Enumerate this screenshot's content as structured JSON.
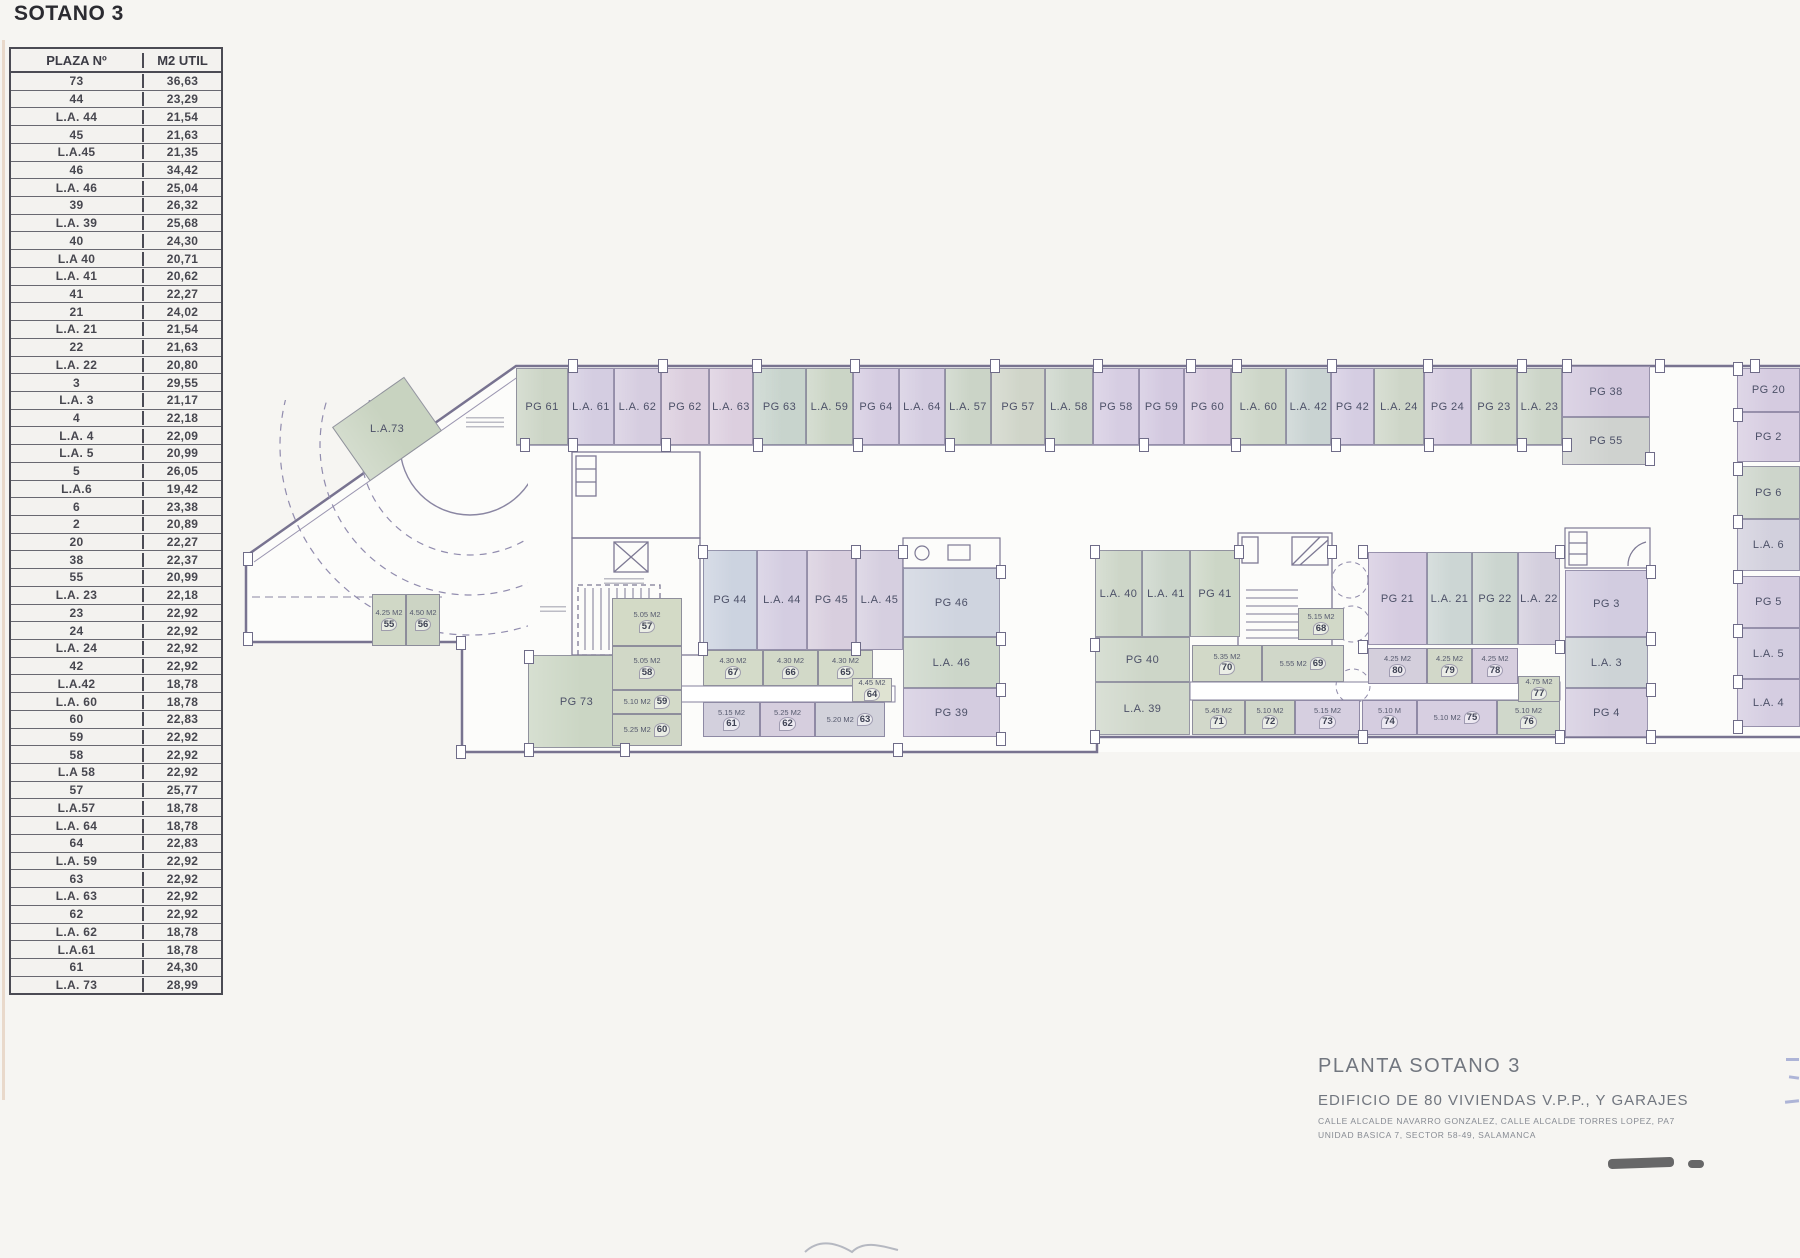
{
  "page_title": "SOTANO 3",
  "table": {
    "headers": [
      "PLAZA Nº",
      "M2 UTIL"
    ],
    "rows": [
      [
        "73",
        "36,63"
      ],
      [
        "44",
        "23,29"
      ],
      [
        "L.A. 44",
        "21,54"
      ],
      [
        "45",
        "21,63"
      ],
      [
        "L.A.45",
        "21,35"
      ],
      [
        "46",
        "34,42"
      ],
      [
        "L.A. 46",
        "25,04"
      ],
      [
        "39",
        "26,32"
      ],
      [
        "L.A. 39",
        "25,68"
      ],
      [
        "40",
        "24,30"
      ],
      [
        "L.A 40",
        "20,71"
      ],
      [
        "L.A. 41",
        "20,62"
      ],
      [
        "41",
        "22,27"
      ],
      [
        "21",
        "24,02"
      ],
      [
        "L.A. 21",
        "21,54"
      ],
      [
        "22",
        "21,63"
      ],
      [
        "L.A. 22",
        "20,80"
      ],
      [
        "3",
        "29,55"
      ],
      [
        "L.A. 3",
        "21,17"
      ],
      [
        "4",
        "22,18"
      ],
      [
        "L.A. 4",
        "22,09"
      ],
      [
        "L.A. 5",
        "20,99"
      ],
      [
        "5",
        "26,05"
      ],
      [
        "L.A.6",
        "19,42"
      ],
      [
        "6",
        "23,38"
      ],
      [
        "2",
        "20,89"
      ],
      [
        "20",
        "22,27"
      ],
      [
        "38",
        "22,37"
      ],
      [
        "55",
        "20,99"
      ],
      [
        "L.A. 23",
        "22,18"
      ],
      [
        "23",
        "22,92"
      ],
      [
        "24",
        "22,92"
      ],
      [
        "L.A. 24",
        "22,92"
      ],
      [
        "42",
        "22,92"
      ],
      [
        "L.A.42",
        "18,78"
      ],
      [
        "L.A. 60",
        "18,78"
      ],
      [
        "60",
        "22,83"
      ],
      [
        "59",
        "22,92"
      ],
      [
        "58",
        "22,92"
      ],
      [
        "L.A 58",
        "22,92"
      ],
      [
        "57",
        "25,77"
      ],
      [
        "L.A.57",
        "18,78"
      ],
      [
        "L.A. 64",
        "18,78"
      ],
      [
        "64",
        "22,83"
      ],
      [
        "L.A. 59",
        "22,92"
      ],
      [
        "63",
        "22,92"
      ],
      [
        "L.A. 63",
        "22,92"
      ],
      [
        "62",
        "22,92"
      ],
      [
        "L.A. 62",
        "18,78"
      ],
      [
        "L.A.61",
        "18,78"
      ],
      [
        "61",
        "24,30"
      ],
      [
        "L.A. 73",
        "28,99"
      ]
    ]
  },
  "plan": {
    "stalls": [
      {
        "label": "PG 61",
        "x": 516,
        "y": 368,
        "w": 52,
        "h": 77,
        "fill": "#ccd5c6"
      },
      {
        "label": "L.A. 61",
        "x": 568,
        "y": 368,
        "w": 46,
        "h": 77,
        "fill": "#d4cde1"
      },
      {
        "label": "L.A. 62",
        "x": 614,
        "y": 368,
        "w": 47,
        "h": 77,
        "fill": "#d6cde0"
      },
      {
        "label": "PG 62",
        "x": 661,
        "y": 368,
        "w": 48,
        "h": 77,
        "fill": "#dbcede"
      },
      {
        "label": "L.A. 63",
        "x": 709,
        "y": 368,
        "w": 44,
        "h": 77,
        "fill": "#dccfdf"
      },
      {
        "label": "PG 63",
        "x": 753,
        "y": 368,
        "w": 53,
        "h": 77,
        "fill": "#c8d4cd"
      },
      {
        "label": "L.A. 59",
        "x": 806,
        "y": 368,
        "w": 47,
        "h": 77,
        "fill": "#cbd5c6"
      },
      {
        "label": "PG 64",
        "x": 853,
        "y": 368,
        "w": 46,
        "h": 77,
        "fill": "#d5cce1"
      },
      {
        "label": "L.A. 64",
        "x": 899,
        "y": 368,
        "w": 46,
        "h": 77,
        "fill": "#d5cde1"
      },
      {
        "label": "L.A. 57",
        "x": 945,
        "y": 368,
        "w": 46,
        "h": 77,
        "fill": "#cbd4c7"
      },
      {
        "label": "PG 57",
        "x": 991,
        "y": 368,
        "w": 54,
        "h": 77,
        "fill": "#d0d5c9"
      },
      {
        "label": "L.A. 58",
        "x": 1045,
        "y": 368,
        "w": 48,
        "h": 77,
        "fill": "#ccd5ca"
      },
      {
        "label": "PG 58",
        "x": 1093,
        "y": 368,
        "w": 46,
        "h": 77,
        "fill": "#d6cde2"
      },
      {
        "label": "PG 59",
        "x": 1139,
        "y": 368,
        "w": 45,
        "h": 77,
        "fill": "#d3c9e0"
      },
      {
        "label": "PG 60",
        "x": 1184,
        "y": 368,
        "w": 47,
        "h": 77,
        "fill": "#d8cce0"
      },
      {
        "label": "L.A. 60",
        "x": 1231,
        "y": 368,
        "w": 55,
        "h": 77,
        "fill": "#cdd6c8"
      },
      {
        "label": "L.A. 42",
        "x": 1286,
        "y": 368,
        "w": 45,
        "h": 77,
        "fill": "#c9d3d2"
      },
      {
        "label": "PG 42",
        "x": 1331,
        "y": 368,
        "w": 43,
        "h": 77,
        "fill": "#d5cde2"
      },
      {
        "label": "L.A. 24",
        "x": 1374,
        "y": 368,
        "w": 50,
        "h": 77,
        "fill": "#ced6c8"
      },
      {
        "label": "PG 24",
        "x": 1424,
        "y": 368,
        "w": 47,
        "h": 77,
        "fill": "#d6cde1"
      },
      {
        "label": "PG 23",
        "x": 1471,
        "y": 368,
        "w": 46,
        "h": 77,
        "fill": "#cfd7c9"
      },
      {
        "label": "L.A. 23",
        "x": 1517,
        "y": 368,
        "w": 45,
        "h": 77,
        "fill": "#ccd5c8"
      },
      {
        "label": "PG 38",
        "x": 1562,
        "y": 366,
        "w": 88,
        "h": 51,
        "fill": "#d3c9de"
      },
      {
        "label": "PG 55",
        "x": 1562,
        "y": 417,
        "w": 88,
        "h": 48,
        "fill": "#cfd2cf"
      },
      {
        "label": "PG 20",
        "x": 1737,
        "y": 368,
        "w": 63,
        "h": 44,
        "fill": "#d5cbe0"
      },
      {
        "label": "PG 2",
        "x": 1737,
        "y": 412,
        "w": 63,
        "h": 50,
        "fill": "#d7cde1"
      },
      {
        "label": "PG 6",
        "x": 1737,
        "y": 466,
        "w": 63,
        "h": 53,
        "fill": "#cdd5cb"
      },
      {
        "label": "L.A. 6",
        "x": 1737,
        "y": 519,
        "w": 63,
        "h": 52,
        "fill": "#d2d0dd"
      },
      {
        "label": "PG 5",
        "x": 1737,
        "y": 576,
        "w": 63,
        "h": 52,
        "fill": "#d4cce0"
      },
      {
        "label": "L.A. 5",
        "x": 1737,
        "y": 628,
        "w": 63,
        "h": 51,
        "fill": "#d3cde0"
      },
      {
        "label": "L.A. 4",
        "x": 1737,
        "y": 679,
        "w": 63,
        "h": 48,
        "fill": "#d5cde1"
      },
      {
        "label": "PG 44",
        "x": 703,
        "y": 550,
        "w": 54,
        "h": 100,
        "fill": "#ccd3e0"
      },
      {
        "label": "L.A. 44",
        "x": 757,
        "y": 550,
        "w": 50,
        "h": 100,
        "fill": "#d4cde1"
      },
      {
        "label": "PG 45",
        "x": 807,
        "y": 550,
        "w": 49,
        "h": 100,
        "fill": "#d8cede"
      },
      {
        "label": "L.A. 45",
        "x": 856,
        "y": 550,
        "w": 47,
        "h": 100,
        "fill": "#d6cfe0"
      },
      {
        "label": "PG 46",
        "x": 903,
        "y": 568,
        "w": 97,
        "h": 69,
        "fill": "#cfd4df"
      },
      {
        "label": "L.A. 46",
        "x": 903,
        "y": 637,
        "w": 97,
        "h": 51,
        "fill": "#ccd6c9"
      },
      {
        "label": "PG 39",
        "x": 903,
        "y": 688,
        "w": 97,
        "h": 49,
        "fill": "#d4cce0"
      },
      {
        "label": "PG 73",
        "x": 528,
        "y": 655,
        "w": 97,
        "h": 93,
        "fill": "#cbd6c4"
      },
      {
        "label": "L.A.73",
        "x": 343,
        "y": 396,
        "w": 88,
        "h": 66,
        "fill": "#c8d3c0",
        "rot": -35
      },
      {
        "label": "L.A. 40",
        "x": 1095,
        "y": 550,
        "w": 47,
        "h": 87,
        "fill": "#cdd6c8"
      },
      {
        "label": "L.A. 41",
        "x": 1142,
        "y": 550,
        "w": 48,
        "h": 87,
        "fill": "#cbd5ca"
      },
      {
        "label": "PG 41",
        "x": 1190,
        "y": 550,
        "w": 50,
        "h": 87,
        "fill": "#ccd6c6"
      },
      {
        "label": "PG 40",
        "x": 1095,
        "y": 637,
        "w": 95,
        "h": 45,
        "fill": "#cdd6c8"
      },
      {
        "label": "L.A. 39",
        "x": 1095,
        "y": 682,
        "w": 95,
        "h": 53,
        "fill": "#cfd7ca"
      },
      {
        "label": "PG 21",
        "x": 1368,
        "y": 552,
        "w": 59,
        "h": 93,
        "fill": "#d5cbe0"
      },
      {
        "label": "L.A. 21",
        "x": 1427,
        "y": 552,
        "w": 45,
        "h": 93,
        "fill": "#ccd6d4"
      },
      {
        "label": "PG 22",
        "x": 1472,
        "y": 552,
        "w": 46,
        "h": 93,
        "fill": "#cbd5cf"
      },
      {
        "label": "L.A. 22",
        "x": 1518,
        "y": 552,
        "w": 42,
        "h": 93,
        "fill": "#d3cedd"
      },
      {
        "label": "PG 3",
        "x": 1565,
        "y": 570,
        "w": 83,
        "h": 67,
        "fill": "#d2cce0"
      },
      {
        "label": "L.A. 3",
        "x": 1565,
        "y": 637,
        "w": 83,
        "h": 51,
        "fill": "#cdd3d6"
      },
      {
        "label": "PG 4",
        "x": 1565,
        "y": 688,
        "w": 83,
        "h": 49,
        "fill": "#d4ccdf"
      }
    ],
    "storerooms": [
      {
        "tag": "55",
        "area": "4.25 M2",
        "x": 372,
        "y": 594,
        "w": 34,
        "h": 52,
        "fill": "#d0d8c6"
      },
      {
        "tag": "56",
        "area": "4.50 M2",
        "x": 406,
        "y": 594,
        "w": 34,
        "h": 52,
        "fill": "#ccd4c4"
      },
      {
        "tag": "57",
        "area": "5.05 M2",
        "x": 612,
        "y": 598,
        "w": 70,
        "h": 48,
        "fill": "#d3dac6"
      },
      {
        "tag": "58",
        "area": "5.05 M2",
        "x": 612,
        "y": 646,
        "w": 70,
        "h": 44,
        "fill": "#d1d8c7"
      },
      {
        "tag": "59",
        "area": "5.10 M2",
        "x": 612,
        "y": 690,
        "w": 70,
        "h": 24,
        "fill": "#d3dac8"
      },
      {
        "tag": "60",
        "area": "5.25 M2",
        "x": 612,
        "y": 714,
        "w": 70,
        "h": 32,
        "fill": "#d0d7c6"
      },
      {
        "tag": "67",
        "area": "4.30 M2",
        "x": 703,
        "y": 650,
        "w": 60,
        "h": 36,
        "fill": "#d4dbc9"
      },
      {
        "tag": "66",
        "area": "4.30 M2",
        "x": 763,
        "y": 650,
        "w": 55,
        "h": 36,
        "fill": "#d2d9c8"
      },
      {
        "tag": "65",
        "area": "4.30 M2",
        "x": 818,
        "y": 650,
        "w": 55,
        "h": 36,
        "fill": "#d4dbc9"
      },
      {
        "tag": "64",
        "area": "4.45 M2",
        "x": 852,
        "y": 678,
        "w": 40,
        "h": 24,
        "fill": "#dfe3d2"
      },
      {
        "tag": "61",
        "area": "5.15 M2",
        "x": 703,
        "y": 702,
        "w": 57,
        "h": 35,
        "fill": "#d3d0dd"
      },
      {
        "tag": "62",
        "area": "5.25 M2",
        "x": 760,
        "y": 702,
        "w": 55,
        "h": 35,
        "fill": "#d6cede"
      },
      {
        "tag": "63",
        "area": "5.20 M2",
        "x": 815,
        "y": 702,
        "w": 70,
        "h": 35,
        "fill": "#d2d2db"
      },
      {
        "tag": "68",
        "area": "5.15 M2",
        "x": 1298,
        "y": 608,
        "w": 46,
        "h": 32,
        "fill": "#d2d9c8"
      },
      {
        "tag": "70",
        "area": "5.35 M2",
        "x": 1192,
        "y": 645,
        "w": 70,
        "h": 37,
        "fill": "#d2d9c8"
      },
      {
        "tag": "69",
        "area": "5.55 M2",
        "x": 1262,
        "y": 645,
        "w": 82,
        "h": 37,
        "fill": "#d0d7c9"
      },
      {
        "tag": "71",
        "area": "5.45 M2",
        "x": 1192,
        "y": 700,
        "w": 53,
        "h": 35,
        "fill": "#d2d8ca"
      },
      {
        "tag": "72",
        "area": "5.10 M2",
        "x": 1245,
        "y": 700,
        "w": 50,
        "h": 35,
        "fill": "#d0d7c9"
      },
      {
        "tag": "73",
        "area": "5.15 M2",
        "x": 1295,
        "y": 700,
        "w": 65,
        "h": 35,
        "fill": "#d6cfe0"
      },
      {
        "tag": "74",
        "area": "5.10 M",
        "x": 1362,
        "y": 700,
        "w": 55,
        "h": 35,
        "fill": "#d5cde0"
      },
      {
        "tag": "75",
        "area": "5.10 M2",
        "x": 1417,
        "y": 700,
        "w": 80,
        "h": 35,
        "fill": "#d7cfe1"
      },
      {
        "tag": "76",
        "area": "5.10 M2",
        "x": 1497,
        "y": 700,
        "w": 63,
        "h": 35,
        "fill": "#d0d8cb"
      },
      {
        "tag": "80",
        "area": "4.25 M2",
        "x": 1368,
        "y": 648,
        "w": 59,
        "h": 36,
        "fill": "#d4cfdc"
      },
      {
        "tag": "79",
        "area": "4.25 M2",
        "x": 1427,
        "y": 648,
        "w": 45,
        "h": 36,
        "fill": "#d2d8c9"
      },
      {
        "tag": "78",
        "area": "4.25 M2",
        "x": 1472,
        "y": 648,
        "w": 46,
        "h": 36,
        "fill": "#d6cede"
      },
      {
        "tag": "77",
        "area": "4.75 M2",
        "x": 1518,
        "y": 676,
        "w": 42,
        "h": 26,
        "fill": "#d2d9c9"
      }
    ]
  },
  "title_block": {
    "line1": "PLANTA SOTANO 3",
    "line2": "EDIFICIO DE 80 VIVIENDAS V.P.P., Y GARAJES",
    "line3": "CALLE ALCALDE NAVARRO GONZALEZ, CALLE ALCALDE TORRES LOPEZ, PA7",
    "line4": "UNIDAD BASICA 7, SECTOR 58-49, SALAMANCA"
  }
}
